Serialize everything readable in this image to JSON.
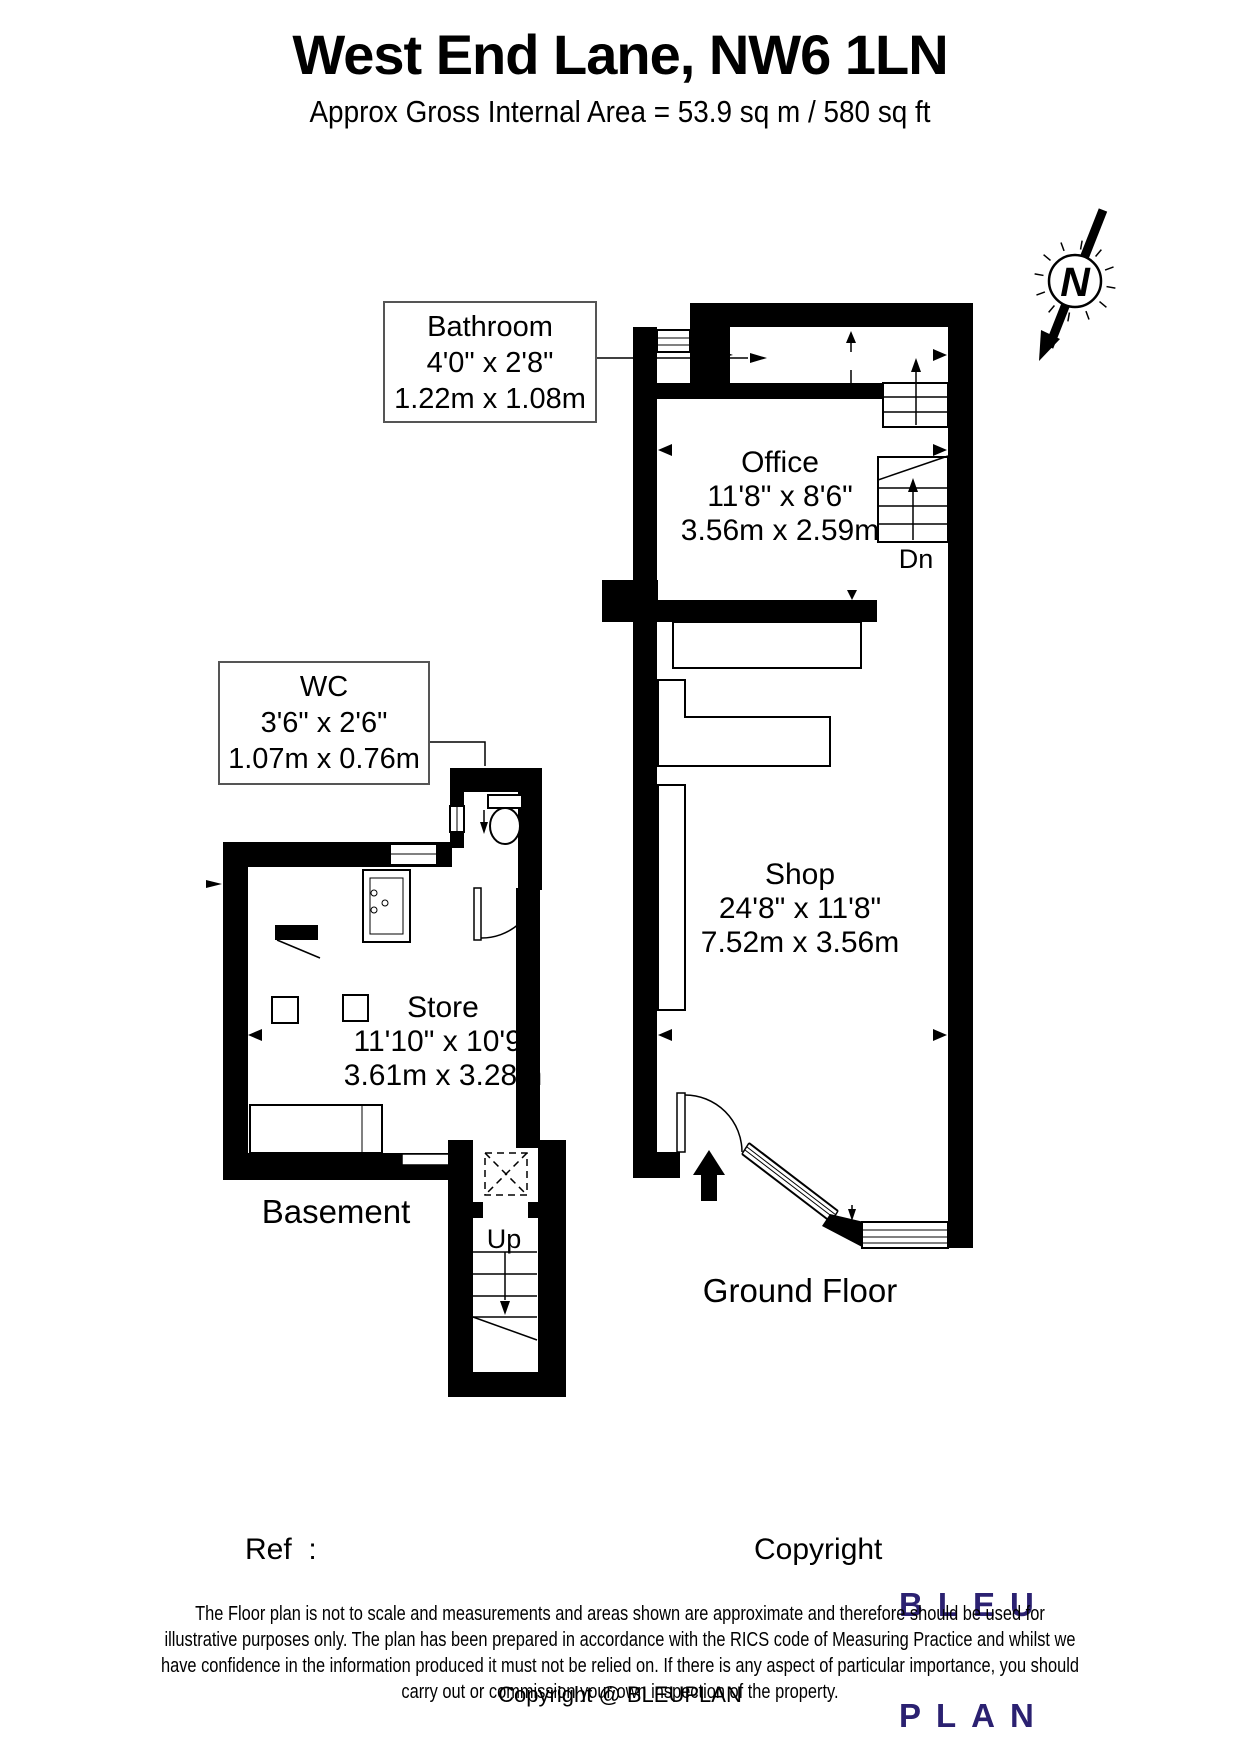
{
  "header": {
    "title": "West End Lane, NW6 1LN",
    "subtitle": "Approx Gross Internal Area = 53.9 sq m / 580 sq ft"
  },
  "compass": {
    "label": "N"
  },
  "labels": {
    "bathroom": {
      "name": "Bathroom",
      "imperial": "4'0\" x 2'8\"",
      "metric": "1.22m x 1.08m"
    },
    "office": {
      "name": "Office",
      "imperial": "11'8\" x 8'6\"",
      "metric": "3.56m x 2.59m"
    },
    "wc": {
      "name": "WC",
      "imperial": "3'6\" x 2'6\"",
      "metric": "1.07m x 0.76m"
    },
    "shop": {
      "name": "Shop",
      "imperial": "24'8\" x 11'8\"",
      "metric": "7.52m x 3.56m"
    },
    "store": {
      "name": "Store",
      "imperial": "11'10\" x 10'9\"",
      "metric": "3.61m x 3.28m"
    },
    "stairs_down": "Dn",
    "stairs_up": "Up",
    "ground_floor": "Ground Floor",
    "basement": "Basement"
  },
  "footer": {
    "ref_label": "Ref  :",
    "copyright_label": "Copyright",
    "logo_line1": "BLEU",
    "logo_line2": "PLAN",
    "logo_color": "#2b2171",
    "disclaimer_lines": [
      "The Floor plan is not to scale and measurements and areas shown are approximate and therefore should be used for",
      "illustrative purposes only. The plan has been prepared in accordance with the RICS code of Measuring Practice and whilst we",
      "have confidence in the information produced it must not be relied on. If there is any aspect of particular importance, you should",
      "carry out or commission your own inspection of the property."
    ],
    "copyright_line": "Copyright @ BLEUPLAN"
  }
}
